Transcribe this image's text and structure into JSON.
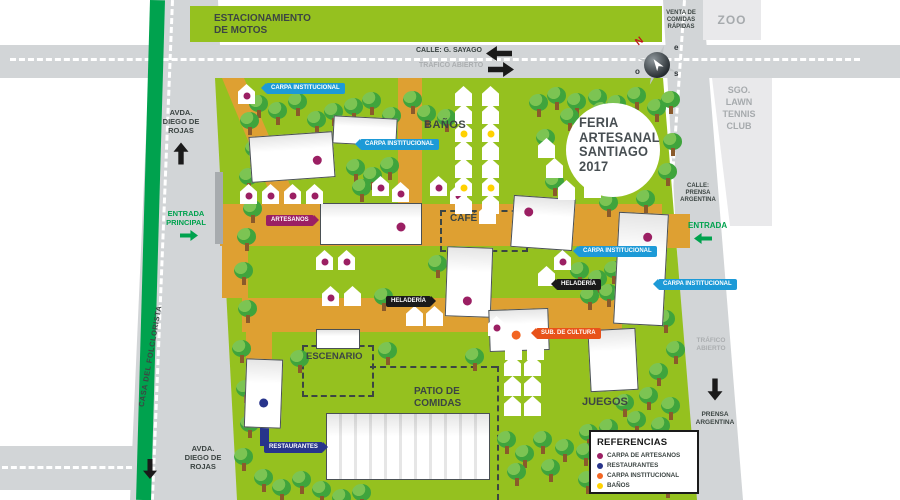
{
  "banner": {
    "estacionamiento": "ESTACIONAMIENTO\nDE MOTOS"
  },
  "streets": {
    "calle_sayago": "CALLE: G. SAYAGO",
    "trafico_abierto_top": "TRÁFICO ABIERTO",
    "venta_comidas": "VENTA DE\nCOMIDAS\nRÁPIDAS",
    "zoo": "ZOO",
    "tennis": "SGO.\nLAWN\nTENNIS\nCLUB",
    "calle_prensa": "CALLE:\nPRENSA\nARGENTINA",
    "entrada_right": "ENTRADA",
    "trafico_abierto_right": "TRÁFICO\nABIERTO",
    "prensa_argentina": "PRENSA\nARGENTINA",
    "avda_rojas_top": "AVDA.\nDIEGO DE\nROJAS",
    "entrada_principal": "ENTRADA\nPRINCIPAL",
    "casa_folclorista": "CASA DEL FOLCLORISTA",
    "avda_rojas_bottom": "AVDA.\nDIEGO DE\nROJAS"
  },
  "park_labels": {
    "banos": "BAÑOS",
    "cafe": "CAFÉ",
    "escenario": "ESCENARIO",
    "patio": "PATIO DE\nCOMIDAS",
    "juegos": "JUEGOS"
  },
  "event_badge": {
    "text": "FERIA\nARTESANAL\nSANTIAGO\n2017"
  },
  "compass": {
    "n": "N",
    "e": "e",
    "s": "s",
    "o": "o"
  },
  "legend": {
    "title": "REFERENCIAS",
    "items": [
      {
        "label": "CARPA DE ARTESANOS",
        "color": "magenta"
      },
      {
        "label": "RESTAURANTES",
        "color": "navy"
      },
      {
        "label": "CARPA INSTITUCIONAL",
        "color": "orange"
      },
      {
        "label": "BAÑOS",
        "color": "yellow"
      }
    ]
  },
  "tags": [
    {
      "label": "CARPA INSTITUCIONAL",
      "color": "blue",
      "x": 266,
      "y": 83,
      "dir": "left"
    },
    {
      "label": "CARPA INSTITUCIONAL",
      "color": "blue",
      "x": 360,
      "y": 139,
      "dir": "left"
    },
    {
      "label": "CARPA INSTITUCIONAL",
      "color": "blue",
      "x": 578,
      "y": 246,
      "dir": "left"
    },
    {
      "label": "CARPA INSTITUCIONAL",
      "color": "blue",
      "x": 658,
      "y": 279,
      "dir": "left"
    },
    {
      "label": "ARTESANOS",
      "color": "magenta",
      "x": 266,
      "y": 215,
      "dir": "right"
    },
    {
      "label": "HELADERÍA",
      "color": "black",
      "x": 386,
      "y": 296,
      "dir": "right"
    },
    {
      "label": "HELADERÍA",
      "color": "black",
      "x": 556,
      "y": 279,
      "dir": "left"
    },
    {
      "label": "SUB. DE CULTURA",
      "color": "red",
      "x": 536,
      "y": 328,
      "dir": "left"
    },
    {
      "label": "RESTAURANTES",
      "color": "navy",
      "x": 264,
      "y": 442,
      "dir": "right"
    }
  ],
  "colors": {
    "magenta": "#9B1F63",
    "navy": "#27348B",
    "orange": "#F26522",
    "yellow": "#FFD100",
    "blue": "#1D9AD7",
    "black": "#1A1A1A",
    "red": "#E8521A",
    "park_green": "#95C11F",
    "path_orange": "#DEA032",
    "road_gray": "#D2D5D7",
    "dark_green": "#00A24E"
  },
  "map": {
    "trees": [
      [
        249,
        95
      ],
      [
        268,
        102
      ],
      [
        288,
        93
      ],
      [
        307,
        111
      ],
      [
        324,
        103
      ],
      [
        344,
        98
      ],
      [
        362,
        92
      ],
      [
        382,
        107
      ],
      [
        403,
        91
      ],
      [
        417,
        105
      ],
      [
        437,
        109
      ],
      [
        529,
        94
      ],
      [
        547,
        87
      ],
      [
        567,
        93
      ],
      [
        588,
        89
      ],
      [
        607,
        95
      ],
      [
        627,
        87
      ],
      [
        647,
        99
      ],
      [
        661,
        91
      ],
      [
        536,
        129
      ],
      [
        545,
        173
      ],
      [
        556,
        194
      ],
      [
        599,
        194
      ],
      [
        636,
        190
      ],
      [
        658,
        163
      ],
      [
        663,
        133
      ],
      [
        560,
        108
      ],
      [
        592,
        102
      ],
      [
        621,
        107
      ],
      [
        346,
        159
      ],
      [
        363,
        167
      ],
      [
        380,
        157
      ],
      [
        352,
        179
      ],
      [
        374,
        288
      ],
      [
        465,
        348
      ],
      [
        428,
        255
      ],
      [
        290,
        350
      ],
      [
        378,
        342
      ],
      [
        570,
        262
      ],
      [
        588,
        270
      ],
      [
        604,
        261
      ],
      [
        580,
        287
      ],
      [
        599,
        284
      ],
      [
        656,
        310
      ],
      [
        666,
        341
      ],
      [
        649,
        363
      ],
      [
        615,
        394
      ],
      [
        639,
        387
      ],
      [
        661,
        397
      ],
      [
        627,
        411
      ],
      [
        651,
        417
      ],
      [
        599,
        419
      ],
      [
        579,
        424
      ],
      [
        497,
        431
      ],
      [
        515,
        445
      ],
      [
        533,
        431
      ],
      [
        507,
        463
      ],
      [
        541,
        459
      ],
      [
        555,
        439
      ],
      [
        576,
        443
      ],
      [
        578,
        471
      ],
      [
        662,
        431
      ],
      [
        676,
        451
      ],
      [
        658,
        475
      ],
      [
        254,
        469
      ],
      [
        272,
        479
      ],
      [
        292,
        471
      ],
      [
        312,
        481
      ],
      [
        332,
        489
      ],
      [
        352,
        484
      ],
      [
        240,
        112
      ],
      [
        245,
        140
      ],
      [
        239,
        168
      ],
      [
        243,
        200
      ],
      [
        237,
        228
      ],
      [
        234,
        262
      ],
      [
        238,
        300
      ],
      [
        232,
        340
      ],
      [
        236,
        380
      ],
      [
        240,
        415
      ],
      [
        234,
        448
      ]
    ],
    "booths": [
      [
        238,
        84,
        "m"
      ],
      [
        240,
        184,
        "m"
      ],
      [
        262,
        184,
        "m"
      ],
      [
        284,
        184,
        "m"
      ],
      [
        306,
        184,
        "m"
      ],
      [
        372,
        176,
        "m"
      ],
      [
        392,
        182,
        "m"
      ],
      [
        430,
        176,
        "m"
      ],
      [
        450,
        184,
        "m"
      ],
      [
        455,
        86,
        "n"
      ],
      [
        455,
        104,
        "n"
      ],
      [
        455,
        122,
        "y"
      ],
      [
        455,
        140,
        "n"
      ],
      [
        455,
        158,
        "n"
      ],
      [
        455,
        176,
        "y"
      ],
      [
        455,
        194,
        "n"
      ],
      [
        482,
        86,
        "n"
      ],
      [
        482,
        104,
        "n"
      ],
      [
        482,
        122,
        "y"
      ],
      [
        482,
        140,
        "n"
      ],
      [
        482,
        158,
        "n"
      ],
      [
        482,
        176,
        "y"
      ],
      [
        482,
        194,
        "n"
      ],
      [
        479,
        204,
        "n"
      ],
      [
        316,
        250,
        "m"
      ],
      [
        338,
        250,
        "m"
      ],
      [
        322,
        286,
        "m"
      ],
      [
        344,
        286,
        "n"
      ],
      [
        406,
        306,
        "n"
      ],
      [
        426,
        306,
        "n"
      ],
      [
        488,
        316,
        "m"
      ],
      [
        505,
        340,
        "n"
      ],
      [
        527,
        340,
        "n"
      ],
      [
        554,
        250,
        "m"
      ],
      [
        538,
        266,
        "n"
      ],
      [
        504,
        356,
        "n"
      ],
      [
        524,
        356,
        "n"
      ],
      [
        504,
        376,
        "n"
      ],
      [
        524,
        376,
        "n"
      ],
      [
        504,
        396,
        "n"
      ],
      [
        524,
        396,
        "n"
      ],
      [
        538,
        138,
        "n"
      ],
      [
        546,
        158,
        "n"
      ],
      [
        558,
        180,
        "n"
      ],
      [
        584,
        178,
        "n"
      ]
    ],
    "marquees": [
      [
        250,
        134,
        84,
        46,
        -4,
        "m",
        80,
        62
      ],
      [
        333,
        117,
        64,
        28,
        3,
        "n",
        50,
        50
      ],
      [
        320,
        203,
        102,
        42,
        0,
        "m",
        80,
        58
      ],
      [
        512,
        197,
        62,
        52,
        4,
        "m",
        25,
        30
      ],
      [
        616,
        213,
        50,
        112,
        3,
        "m",
        60,
        21
      ],
      [
        446,
        247,
        46,
        70,
        2,
        "m",
        48,
        78
      ],
      [
        489,
        309,
        60,
        42,
        -2,
        "o",
        45,
        62
      ],
      [
        589,
        329,
        48,
        62,
        -3,
        "n",
        50,
        50
      ],
      [
        326,
        413,
        164,
        67,
        0,
        "n",
        50,
        50
      ],
      [
        245,
        359,
        37,
        69,
        2,
        "b",
        50,
        64
      ],
      [
        316,
        329,
        44,
        20,
        0,
        "n",
        50,
        50
      ]
    ]
  }
}
